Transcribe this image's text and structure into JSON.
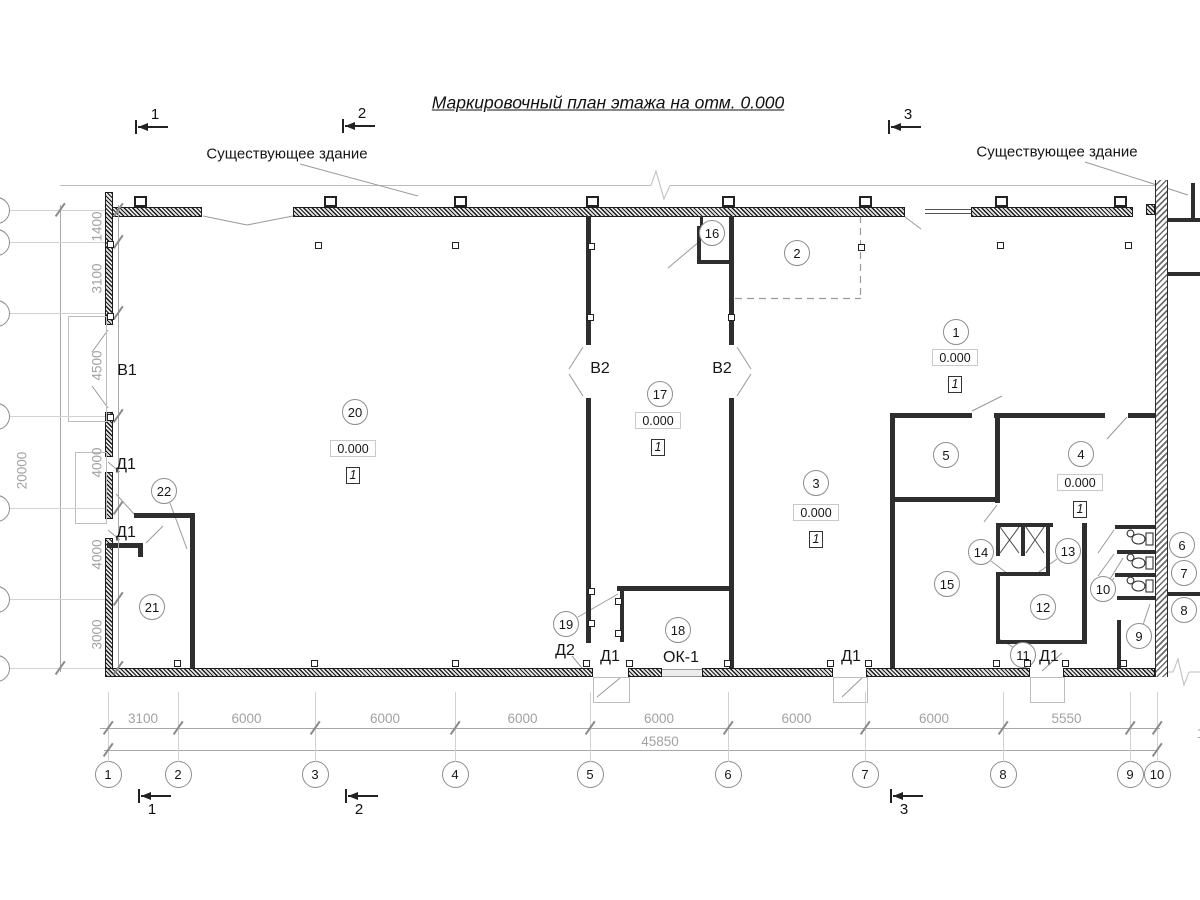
{
  "title": "Маркировочный план этажа на отм. 0.000",
  "labels": {
    "existing_building_left": "Существующее здание",
    "existing_building_right": "Существующее здание"
  },
  "section_markers": {
    "top": [
      {
        "n": "1",
        "x": 135,
        "y": 127
      },
      {
        "n": "2",
        "x": 342,
        "y": 126
      },
      {
        "n": "3",
        "x": 888,
        "y": 127
      }
    ],
    "bottom": [
      {
        "n": "1",
        "x": 138,
        "y": 796
      },
      {
        "n": "2",
        "x": 345,
        "y": 796
      },
      {
        "n": "3",
        "x": 890,
        "y": 796
      }
    ]
  },
  "axes": {
    "bottom": [
      {
        "n": "1",
        "x": 108
      },
      {
        "n": "2",
        "x": 178
      },
      {
        "n": "3",
        "x": 315
      },
      {
        "n": "4",
        "x": 455
      },
      {
        "n": "5",
        "x": 590
      },
      {
        "n": "6",
        "x": 728
      },
      {
        "n": "7",
        "x": 865
      },
      {
        "n": "8",
        "x": 1003
      },
      {
        "n": "9",
        "x": 1130
      },
      {
        "n": "10",
        "x": 1157
      }
    ],
    "left_rows": [
      210,
      242,
      313,
      416,
      508,
      599,
      668
    ]
  },
  "dimensions": {
    "bottom_segments": [
      {
        "label": "3100",
        "x1": 108,
        "x2": 178
      },
      {
        "label": "6000",
        "x1": 178,
        "x2": 315
      },
      {
        "label": "6000",
        "x1": 315,
        "x2": 455
      },
      {
        "label": "6000",
        "x1": 455,
        "x2": 590
      },
      {
        "label": "6000",
        "x1": 590,
        "x2": 728
      },
      {
        "label": "6000",
        "x1": 728,
        "x2": 865
      },
      {
        "label": "6000",
        "x1": 865,
        "x2": 1003
      },
      {
        "label": "5550",
        "x1": 1003,
        "x2": 1130
      }
    ],
    "bottom_total": {
      "label": "45850",
      "x": 660,
      "y": 741
    },
    "offset_note": {
      "label": "1200",
      "x": 1182,
      "y": 733
    },
    "left_segments": [
      {
        "label": "1400",
        "y1": 210,
        "y2": 242
      },
      {
        "label": "3100",
        "y1": 242,
        "y2": 313
      },
      {
        "label": "4500",
        "y1": 313,
        "y2": 416
      },
      {
        "label": "4000",
        "y1": 416,
        "y2": 508
      },
      {
        "label": "4000",
        "y1": 508,
        "y2": 599
      },
      {
        "label": "3000",
        "y1": 599,
        "y2": 668
      }
    ],
    "left_total": {
      "label": "20000",
      "x": 22,
      "y": 470
    }
  },
  "rooms": [
    {
      "n": "1",
      "x": 956,
      "y": 332
    },
    {
      "n": "2",
      "x": 797,
      "y": 253
    },
    {
      "n": "3",
      "x": 816,
      "y": 483
    },
    {
      "n": "4",
      "x": 1081,
      "y": 454
    },
    {
      "n": "5",
      "x": 946,
      "y": 455
    },
    {
      "n": "6",
      "x": 1182,
      "y": 545
    },
    {
      "n": "7",
      "x": 1184,
      "y": 573
    },
    {
      "n": "8",
      "x": 1184,
      "y": 610
    },
    {
      "n": "9",
      "x": 1139,
      "y": 636
    },
    {
      "n": "10",
      "x": 1103,
      "y": 589
    },
    {
      "n": "11",
      "x": 1023,
      "y": 655
    },
    {
      "n": "12",
      "x": 1043,
      "y": 607
    },
    {
      "n": "13",
      "x": 1068,
      "y": 551
    },
    {
      "n": "14",
      "x": 981,
      "y": 552
    },
    {
      "n": "15",
      "x": 947,
      "y": 584
    },
    {
      "n": "16",
      "x": 712,
      "y": 233
    },
    {
      "n": "17",
      "x": 660,
      "y": 394
    },
    {
      "n": "18",
      "x": 678,
      "y": 630
    },
    {
      "n": "19",
      "x": 566,
      "y": 624
    },
    {
      "n": "20",
      "x": 355,
      "y": 412
    },
    {
      "n": "21",
      "x": 152,
      "y": 607
    },
    {
      "n": "22",
      "x": 164,
      "y": 491
    }
  ],
  "elevation_marks": [
    {
      "value": "0.000",
      "floor": "1",
      "x": 353,
      "y": 448
    },
    {
      "value": "0.000",
      "floor": "1",
      "x": 658,
      "y": 420
    },
    {
      "value": "0.000",
      "floor": "1",
      "x": 816,
      "y": 512
    },
    {
      "value": "0.000",
      "floor": "1",
      "x": 955,
      "y": 357
    },
    {
      "value": "0.000",
      "floor": "1",
      "x": 1080,
      "y": 482
    }
  ],
  "plan_labels": [
    {
      "text": "В1",
      "x": 127,
      "y": 371
    },
    {
      "text": "В2",
      "x": 600,
      "y": 369
    },
    {
      "text": "В2",
      "x": 722,
      "y": 369
    },
    {
      "text": "Д1",
      "x": 126,
      "y": 465
    },
    {
      "text": "Д1",
      "x": 126,
      "y": 533
    },
    {
      "text": "Д2",
      "x": 565,
      "y": 651
    },
    {
      "text": "Д1",
      "x": 610,
      "y": 657
    },
    {
      "text": "ОК-1",
      "x": 681,
      "y": 658
    },
    {
      "text": "Д1",
      "x": 851,
      "y": 657
    },
    {
      "text": "Д1",
      "x": 1049,
      "y": 657
    }
  ]
}
